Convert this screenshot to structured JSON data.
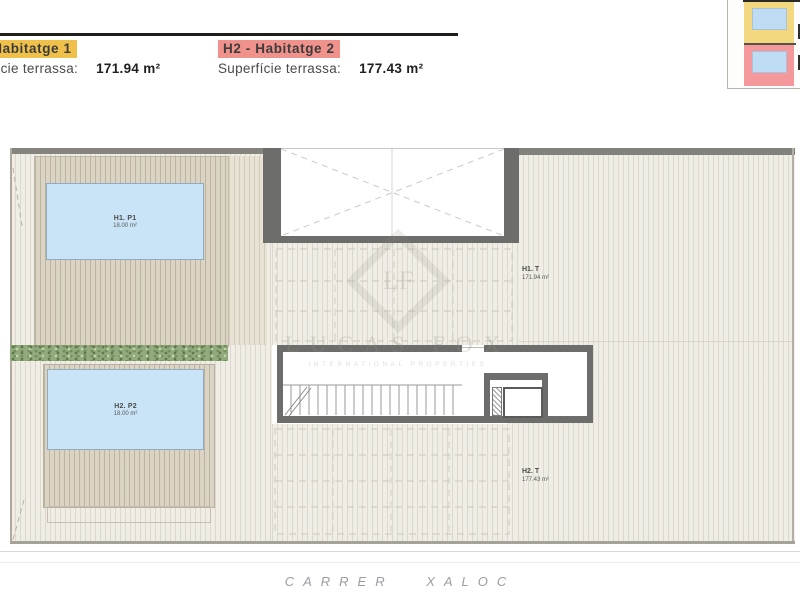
{
  "legends": [
    {
      "title": "H1 - Habitatge 1",
      "area_label": "Superfície terrassa:",
      "area_value": "171.94 m²",
      "highlight": "#efc04a"
    },
    {
      "title": "H2 - Habitatge 2",
      "area_label": "Superfície terrassa:",
      "area_value": "177.43 m²",
      "highlight": "#f0928b"
    }
  ],
  "plan": {
    "pool1": {
      "name": "H1. P1",
      "area": "18.00 m²"
    },
    "pool2": {
      "name": "H2. P2",
      "area": "18.00 m²"
    },
    "terrace1": {
      "name": "H1. T",
      "area": "171.94 m²"
    },
    "terrace2": {
      "name": "H2. T",
      "area": "177.43 m²"
    }
  },
  "watermark": {
    "monogram": "LF",
    "name": "LUCAS FOX",
    "tagline": "INTERNATIONAL PROPERTIES"
  },
  "street": "CARRER XALOC",
  "colors": {
    "legend_yellow": "#efc04a",
    "legend_red": "#f0928b",
    "pool_blue": "#c9e4f7",
    "hedge_green": "#93aa7f",
    "wall_gray": "#6d6d6b",
    "deck_light": "#f0ede5",
    "deck_dark": "#dbd3c4",
    "minimap_yellow": "#f3d880",
    "minimap_pink": "#f4989c",
    "minimap_blue": "#bedcf4"
  }
}
